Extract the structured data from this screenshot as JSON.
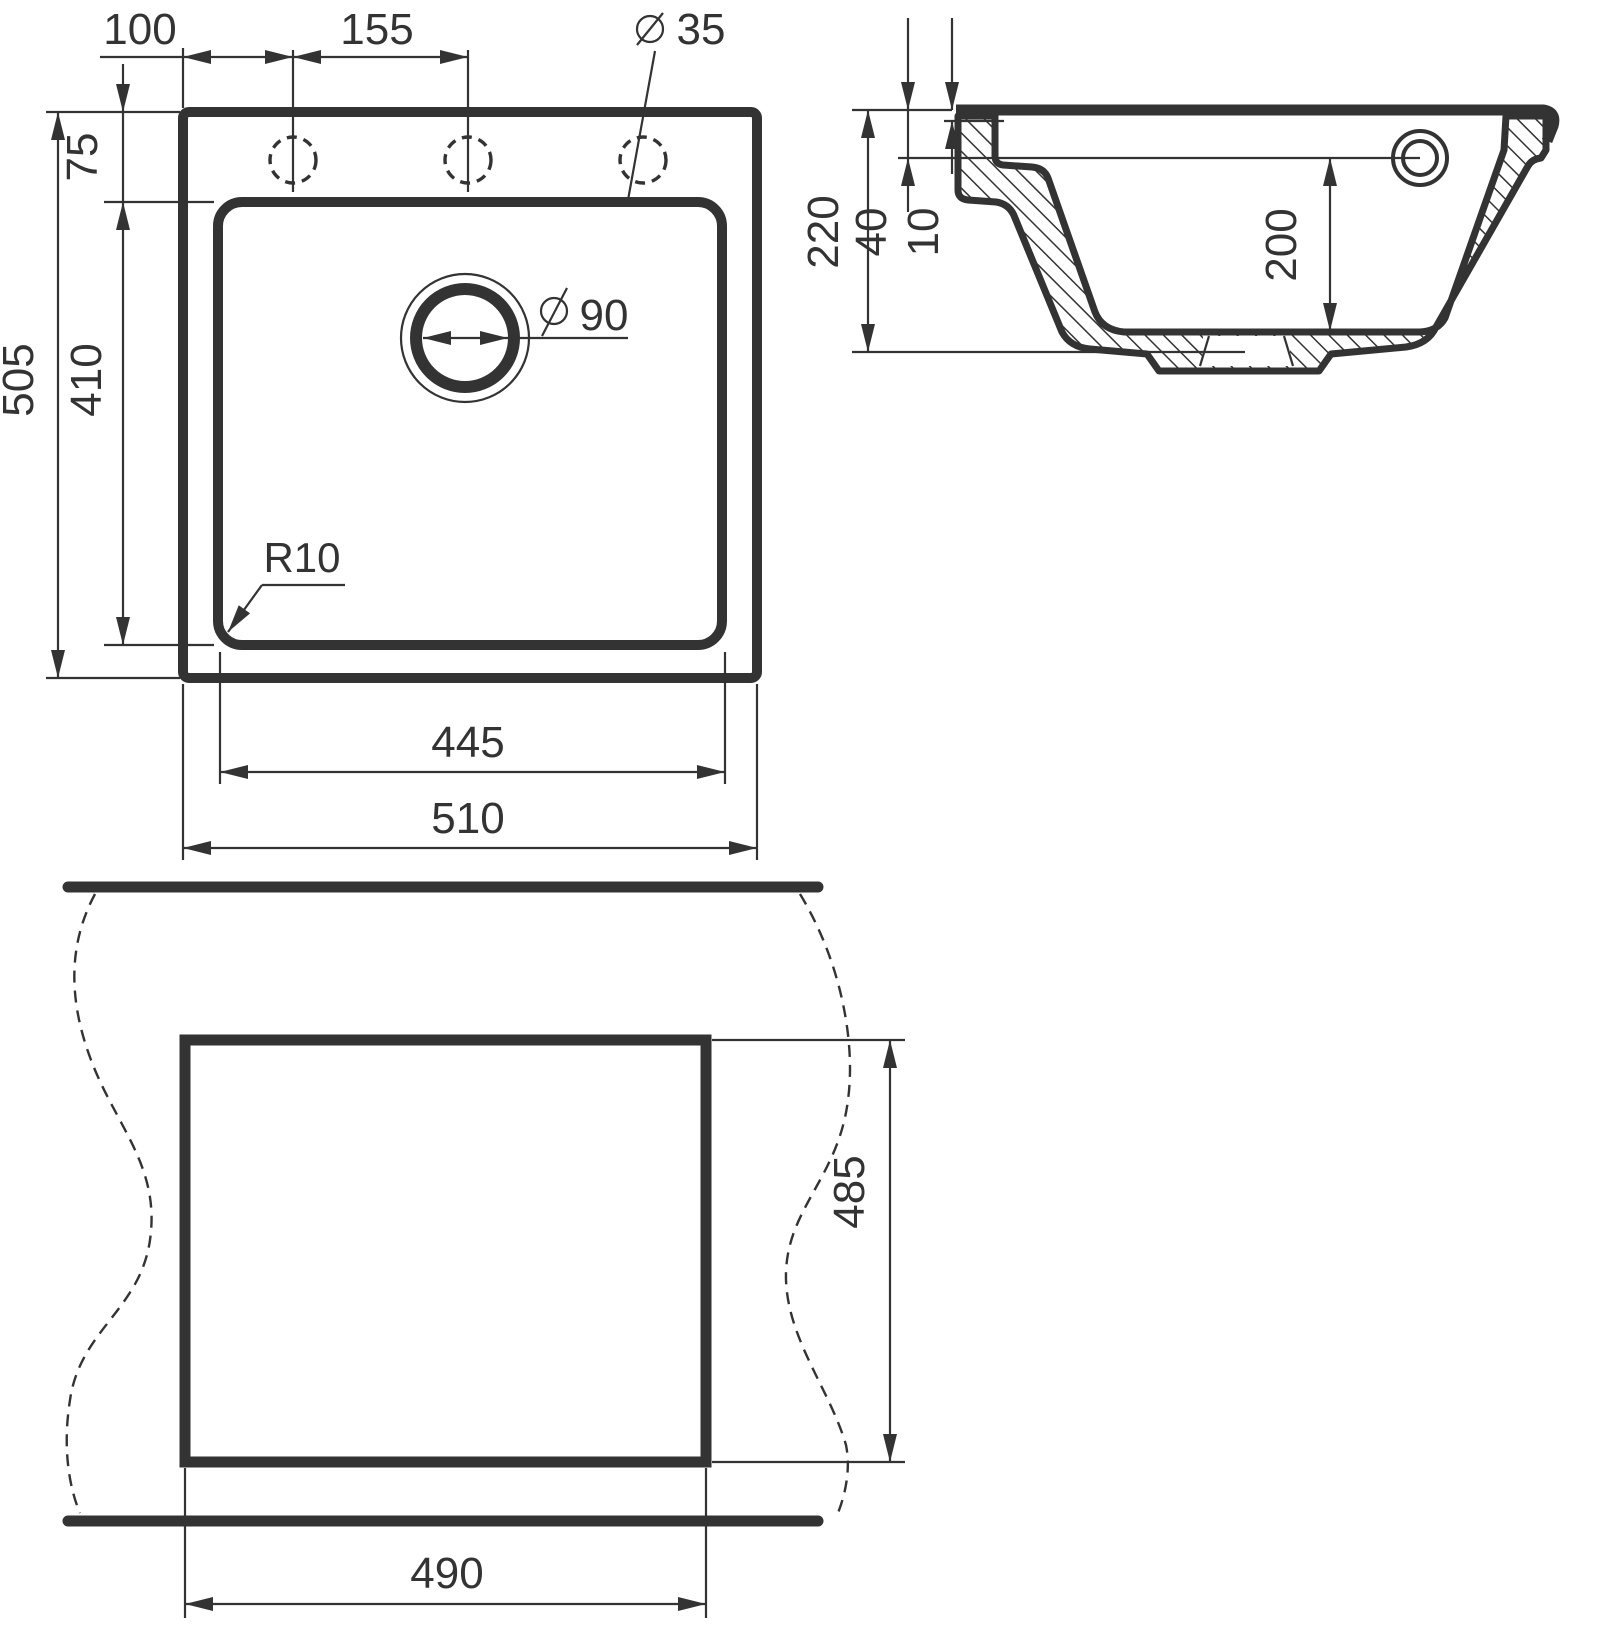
{
  "drawing": {
    "plan": {
      "dim_hole_offset": "100",
      "dim_hole_spacing": "155",
      "hole_diameter": "35",
      "dim_rim_to_bowl": "75",
      "dim_overall_depth": "505",
      "dim_bowl_depth": "410",
      "dim_bowl_width": "445",
      "dim_overall_width": "510",
      "drain_diameter": "90",
      "corner_radius": "R10"
    },
    "section": {
      "dim_total_height": "220",
      "dim_ledge_depth": "40",
      "dim_rim_thickness": "10",
      "dim_bowl_depth": "200"
    },
    "cutout": {
      "dim_width": "490",
      "dim_height": "485"
    }
  },
  "colors": {
    "line": "#333333",
    "background": "#ffffff"
  }
}
